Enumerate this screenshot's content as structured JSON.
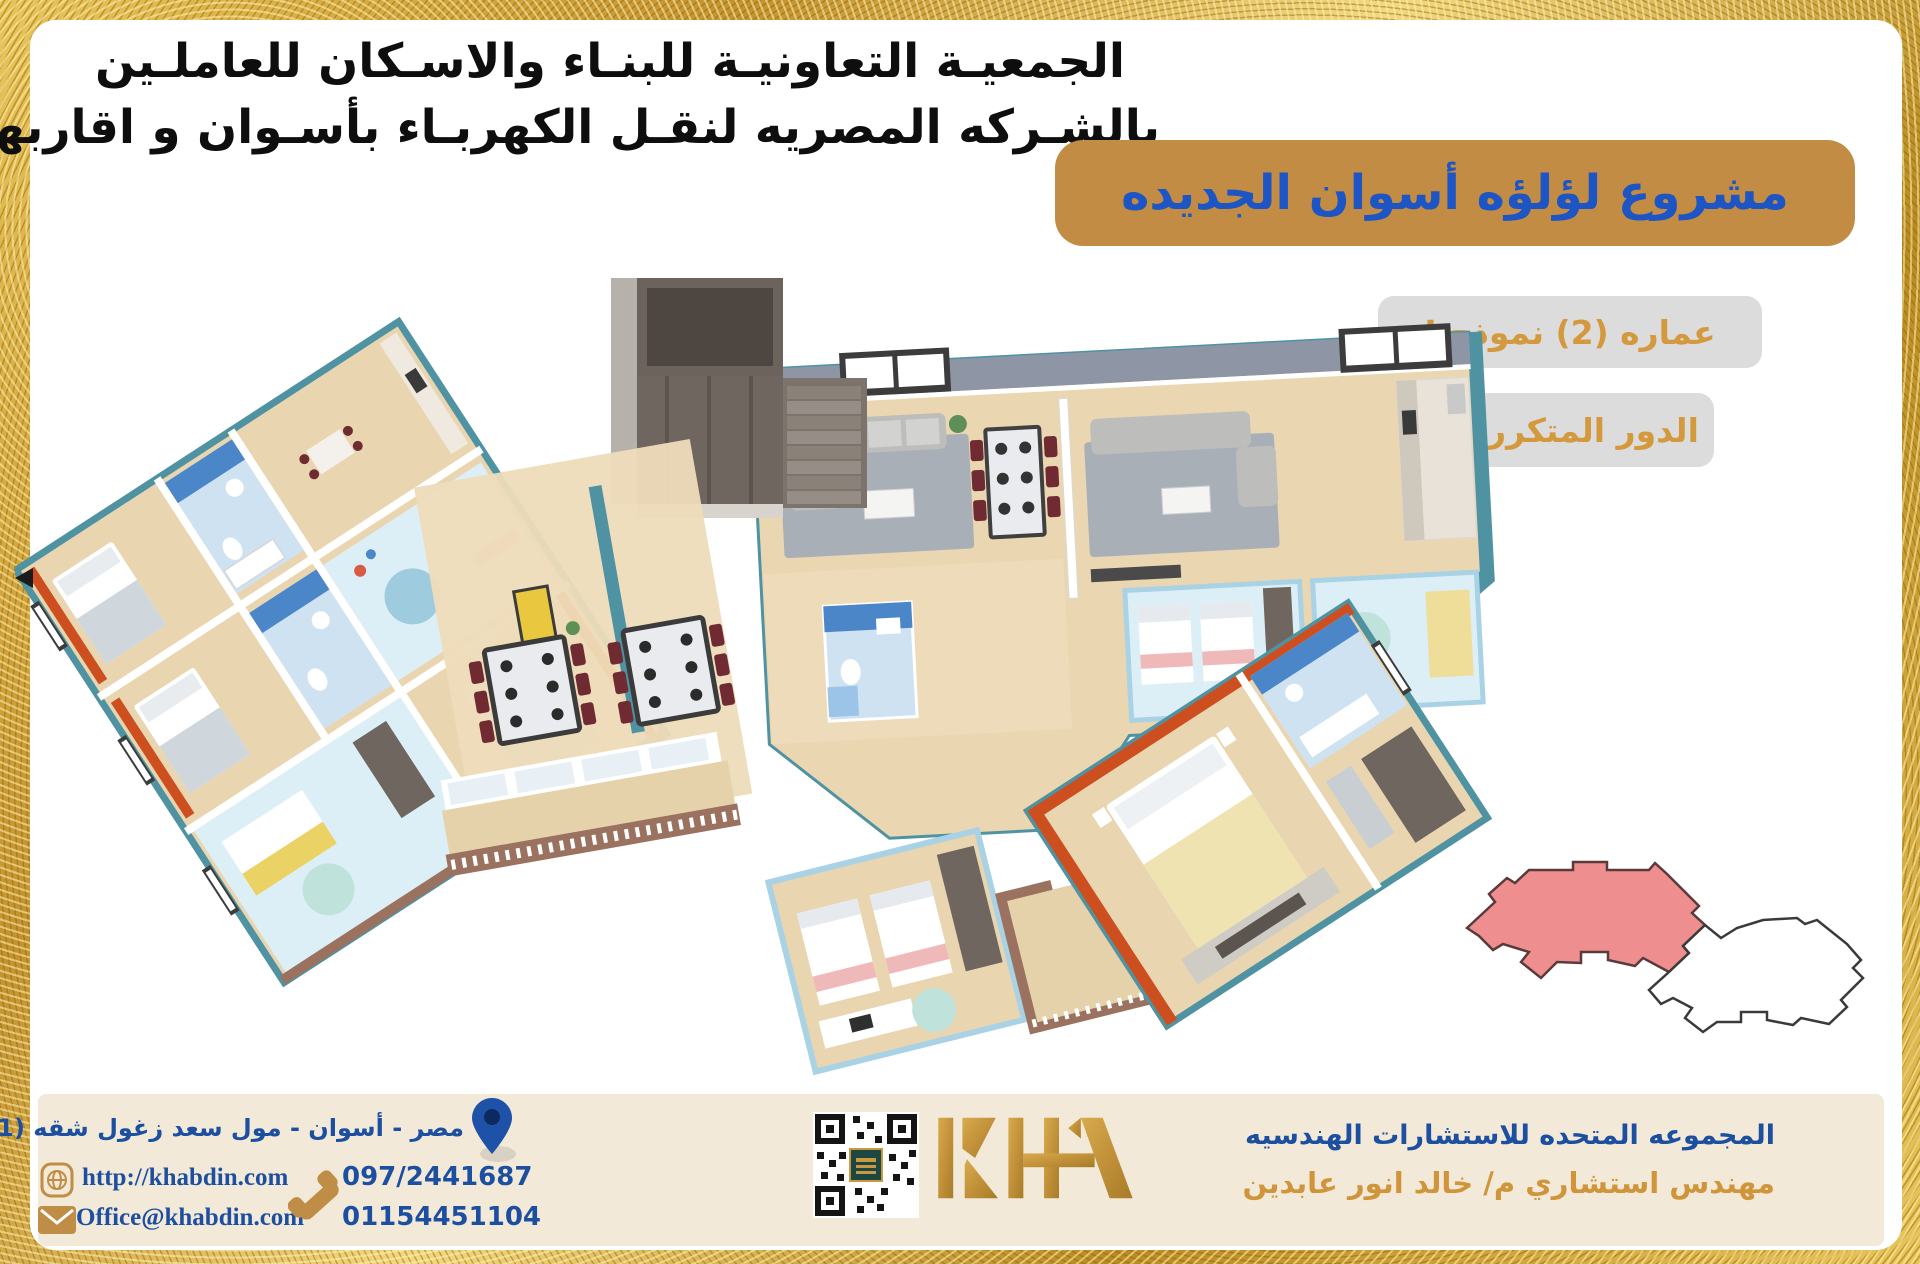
{
  "header": {
    "line1": "الجمعيـة التعاونيـة للبنـاء والاسـكان للعاملـين",
    "line2": "بالشـركه المصريه لنقـل الكهربـاء بأسـوان و اقاربهـم"
  },
  "project_badge": {
    "label": "مشروع لؤلؤه أسوان الجديده",
    "bg_color": "#c28c44",
    "text_color": "#1d55c4"
  },
  "unit_badges": [
    {
      "label": "عماره (2) نموذج J",
      "bg_color": "#dcdcdc",
      "text_color": "#d3993c"
    },
    {
      "label": "الدور المتكرر",
      "bg_color": "#dcdcdc",
      "text_color": "#d3993c"
    }
  ],
  "key_plan": {
    "highlight_color": "#ef8e8e",
    "outline_color": "#3a3a3a",
    "description": "building footprint key plan, left block highlighted"
  },
  "floor_plan": {
    "description": "3D axonometric render of repeated floor with four apartments",
    "wall_color": "#4f93a3",
    "accent_wall_color": "#cd4f1f",
    "floor_color": "#e9d6b1"
  },
  "footer": {
    "address": "مصر - أسوان - مول سعد زغول شقه (201)",
    "website": "http://khabdin.com",
    "email": "Office@khabdin.com",
    "phone1": "097/2441687",
    "phone2": "01154451104",
    "logo_text": "KHA",
    "company_line1": "المجموعه المتحده للاستشارات الهندسيه",
    "company_line2": "مهندس استشاري م/ خالد انور عابدين",
    "band_color": "#f3e9d8",
    "icon_gold": "#bf8d45",
    "pin_blue": "#1e52a8"
  }
}
